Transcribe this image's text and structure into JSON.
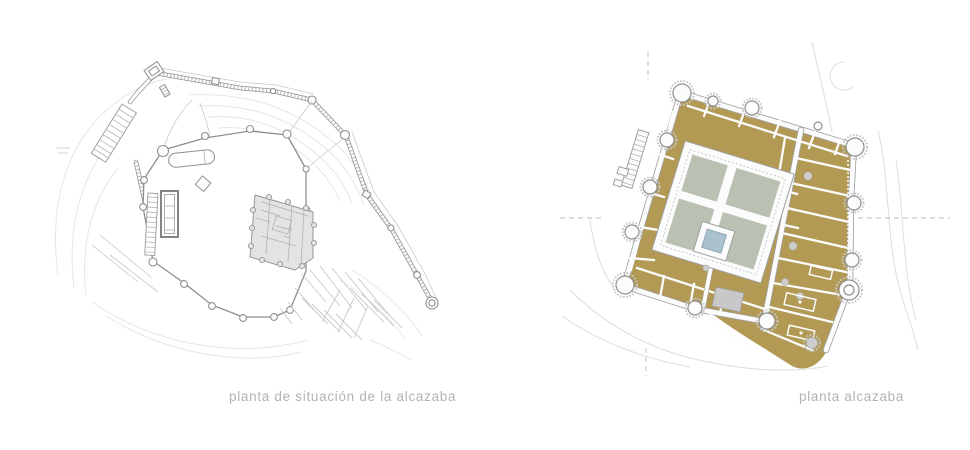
{
  "page": {
    "width": 970,
    "height": 450,
    "background": "#ffffff"
  },
  "figures": [
    {
      "id": "site-plan",
      "caption": "planta de situación de la alcazaba",
      "style": "gray line drawing"
    },
    {
      "id": "alcazaba-plan",
      "caption": "planta alcazaba",
      "style": "colored floor plan"
    }
  ],
  "colors": {
    "page": "#ffffff",
    "caption": "#b2b2b2",
    "line": "#8f8f8f",
    "line-light": "#c9c9c9",
    "contour": "#e6e6e6",
    "contour-warm": "#dfdcd4",
    "palace-fill": "#e3e3e5",
    "tan": "#b39a54",
    "sage": "#b9c1b2",
    "pool": "#a9c2ce",
    "gray-room": "#c8c8c8",
    "white-wall": "#fcfcfc",
    "dash": "#bbbbbb"
  }
}
